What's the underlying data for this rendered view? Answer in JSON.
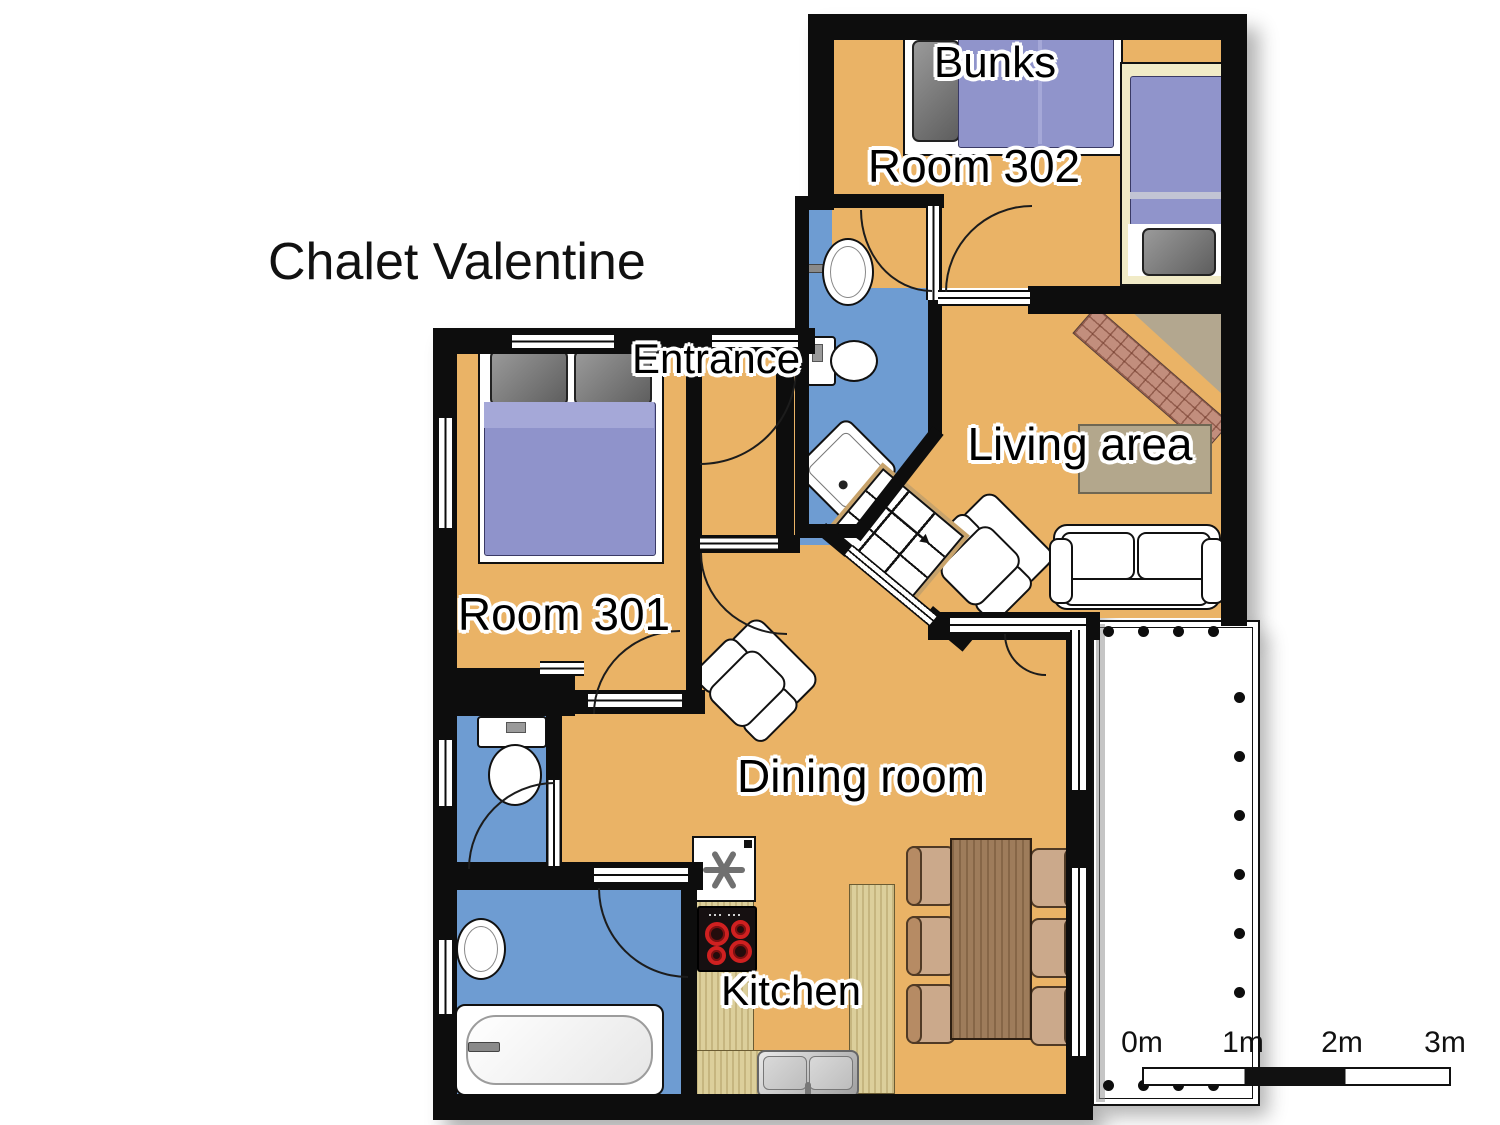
{
  "labels": {
    "title": "Chalet Valentine",
    "bunks": "Bunks",
    "room302": "Room 302",
    "entrance": "Entrance",
    "living": "Living area",
    "room301": "Room 301",
    "dining": "Dining room",
    "kitchen": "Kitchen"
  },
  "scale_bar": {
    "labels": [
      "0m",
      "1m",
      "2m",
      "3m"
    ]
  },
  "colors": {
    "floor": "#EAB366",
    "wet_room": "#6E9CD2",
    "wall": "#0D0D0D",
    "bed": "#9094CB",
    "counter": "#DCCF9B",
    "table": "#9E7C5B"
  },
  "icons": {
    "freezer_icon": "asterisk",
    "stairs_arrow_icon": "arrow-up"
  }
}
